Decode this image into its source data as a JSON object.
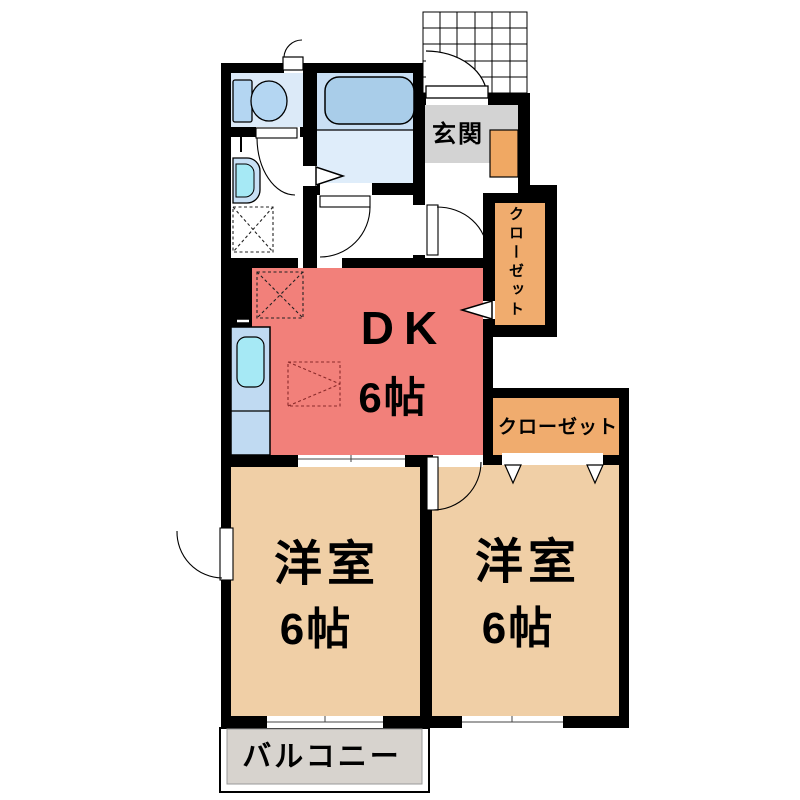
{
  "plan": {
    "type": "apartment floor plan (2DK)",
    "genkan": {
      "label": "玄関"
    },
    "closet_north": {
      "label": "クローゼット"
    },
    "closet_east": {
      "label": "クローゼット"
    },
    "dk": {
      "label": "DK",
      "size": "6帖"
    },
    "bedroom_west": {
      "label": "洋室",
      "size": "6帖"
    },
    "bedroom_east": {
      "label": "洋室",
      "size": "6帖"
    },
    "balcony": {
      "label": "バルコニー"
    }
  },
  "fixtures": [
    "toilet",
    "bathtub",
    "washbasin",
    "kitchen-sink",
    "washing-machine-space",
    "refrigerator-space",
    "entrance-door",
    "porch-tile-grid",
    "entry-arrows",
    "closet-door-marks"
  ],
  "colors": {
    "dk": "#F2807A",
    "bedroom": "#F0CFA6",
    "closet": "#F0AC6E",
    "genkan-floor": "#D3D3D3",
    "shoe-cabinet": "#F0A863",
    "bath-upper": "#C9DFF4",
    "bath-lower": "#DFEDFA",
    "toilet-room": "#DCEAF8",
    "fixture-blue": "#B4D6F2",
    "tub-blue": "#A9CDE9",
    "counter-blue": "#C0DAF2",
    "sink-cyan": "#A6E9F5",
    "basin-outer": "#C8E0F5",
    "balcony-floor": "#D7D3CE",
    "wall": "#000000"
  }
}
